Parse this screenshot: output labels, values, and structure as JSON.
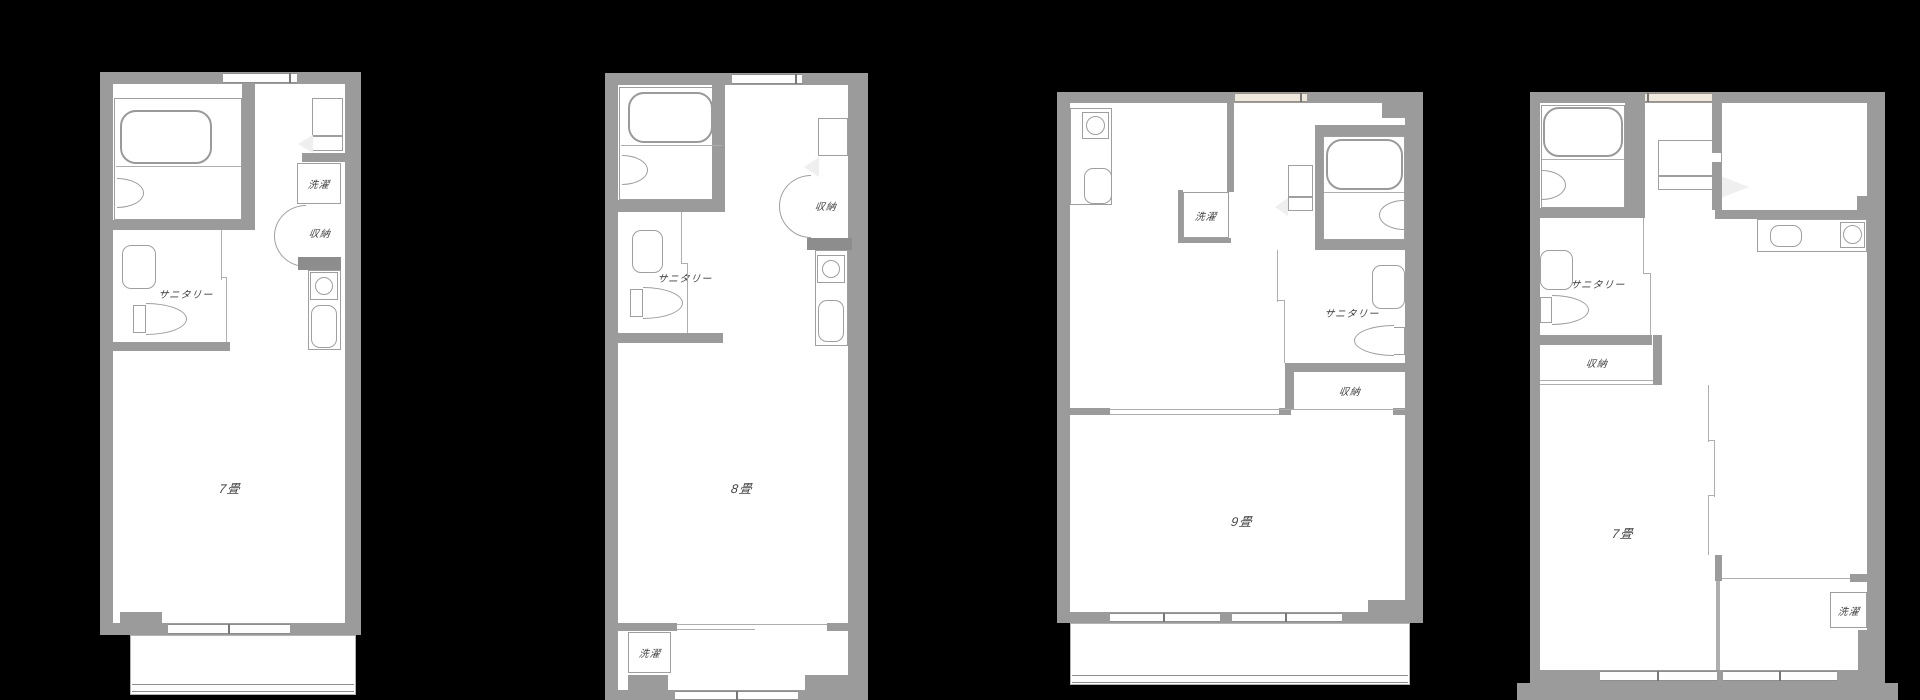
{
  "canvas": {
    "background": "#000000",
    "wall_color": "#9b9b9b",
    "floor_color": "#ffffff",
    "line_color": "#9f9f9f",
    "label_color": "#3f3f3f"
  },
  "plans": [
    {
      "name": "plan-1",
      "room_size": "7畳",
      "labels": {
        "laundry": "洗濯",
        "storage": "収納",
        "sanitary": "サニタリー"
      }
    },
    {
      "name": "plan-2",
      "room_size": "8畳",
      "labels": {
        "sanitary": "サニタリー",
        "storage": "収納",
        "laundry": "洗濯"
      }
    },
    {
      "name": "plan-3",
      "room_size": "9畳",
      "labels": {
        "laundry": "洗濯",
        "sanitary": "サニタリー",
        "storage": "収納"
      }
    },
    {
      "name": "plan-4",
      "room_size": "7畳",
      "labels": {
        "sanitary": "サニタリー",
        "storage": "収納",
        "laundry": "洗濯"
      }
    }
  ]
}
